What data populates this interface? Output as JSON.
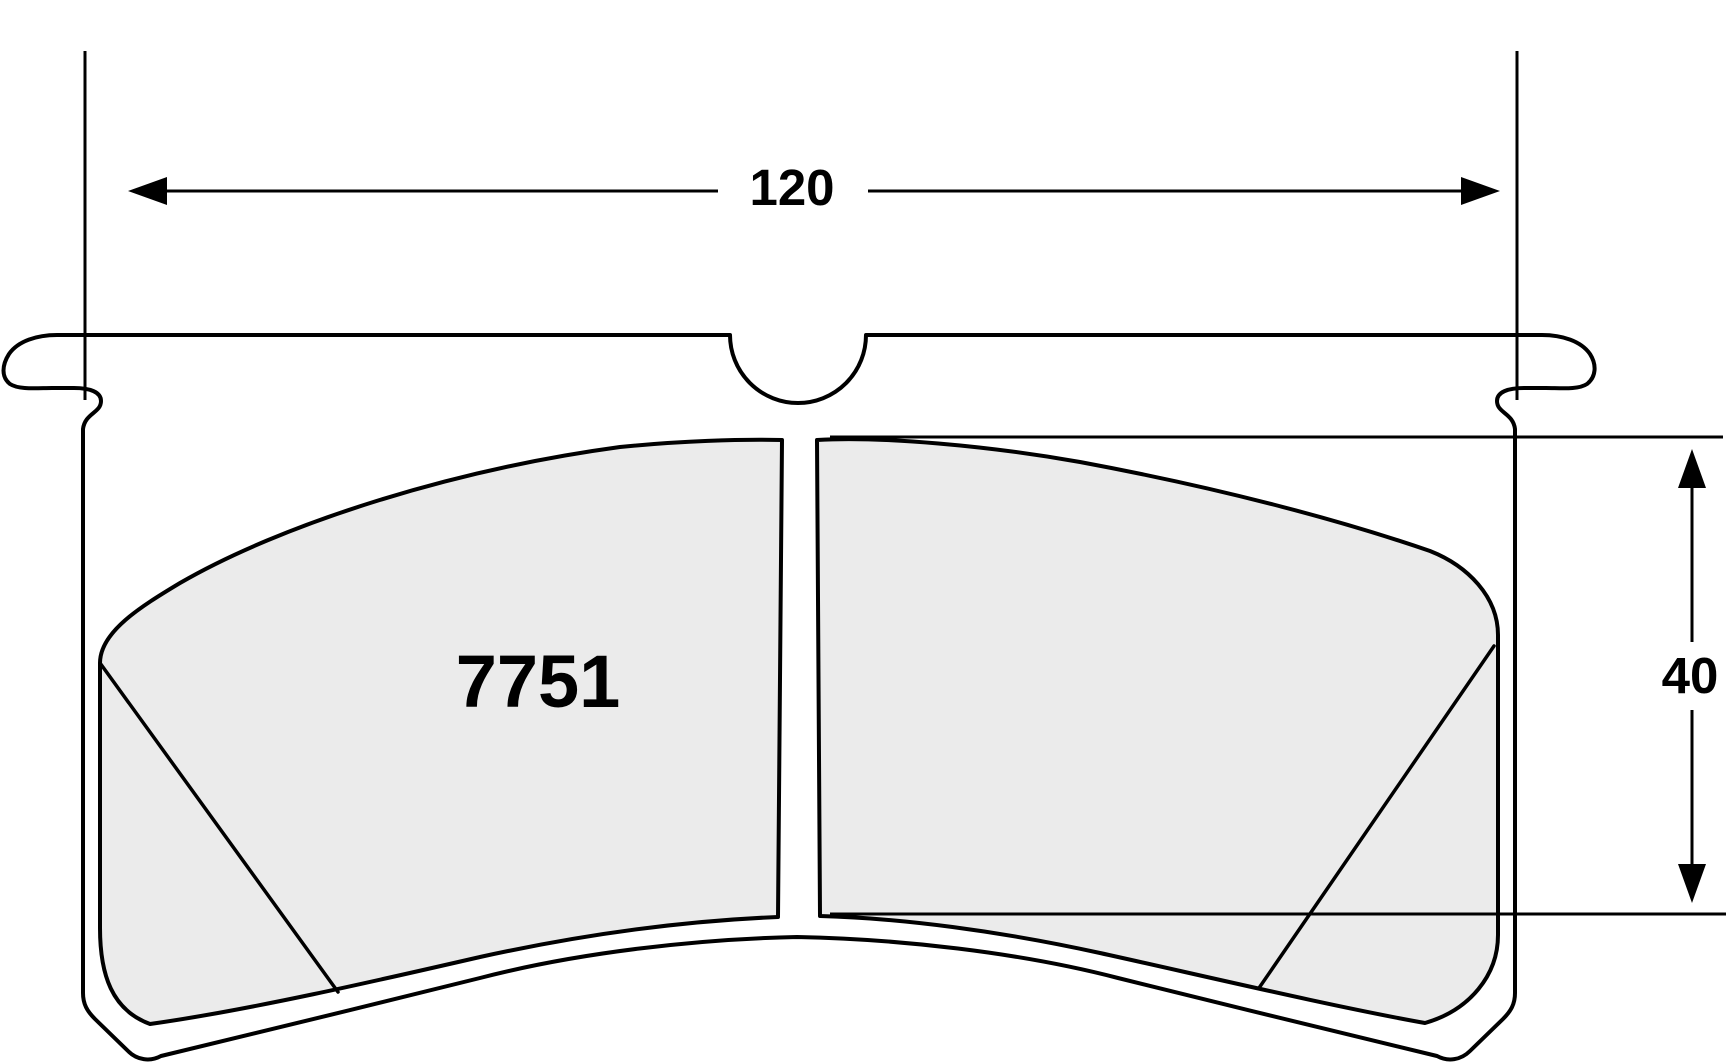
{
  "drawing": {
    "part_number": "7751",
    "width_dimension_label": "120",
    "height_dimension_label": "40"
  },
  "colors": {
    "line": "#000000",
    "pad_fill": "#EBEBEB",
    "background": "#FFFFFF"
  }
}
